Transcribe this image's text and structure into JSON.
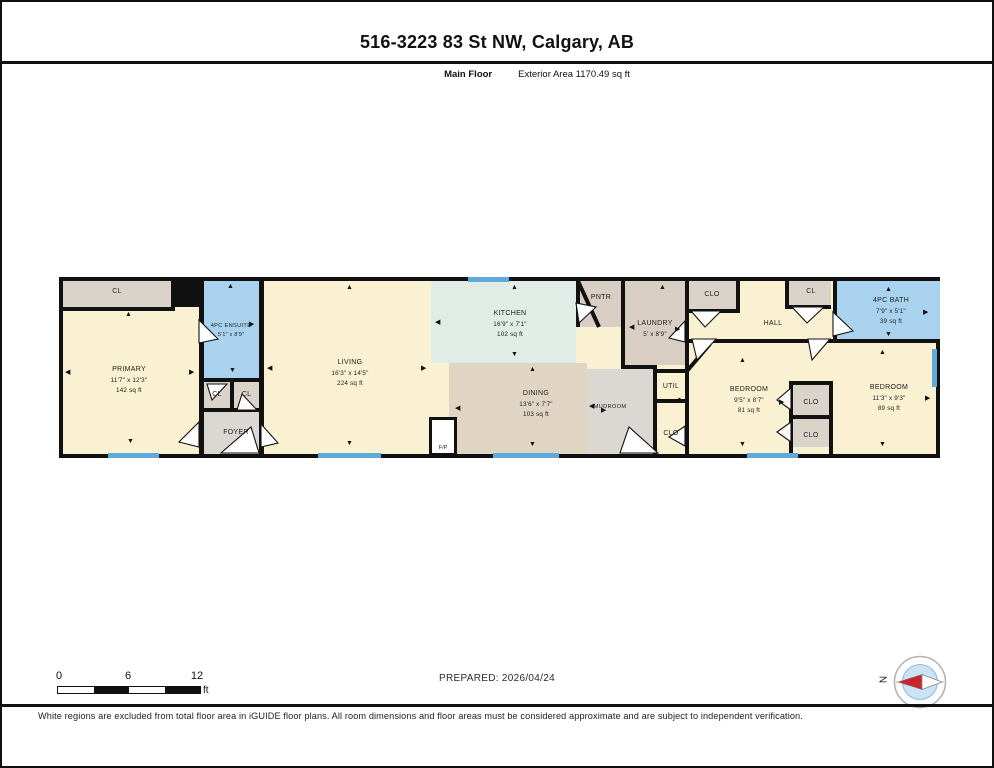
{
  "page": {
    "title": "516-3223 83 St NW, Calgary, AB",
    "floor_label": "Main Floor",
    "area_label": "Exterior Area 1170.49 sq ft",
    "prepared_label": "PREPARED: 2026/04/24",
    "compass_north": "N",
    "disclaimer": "White regions are excluded from total floor area in iGUIDE floor plans. All room dimensions and floor areas must be considered approximate and are subject to independent verification."
  },
  "scale_bar": {
    "start": "0",
    "mid": "6",
    "end": "12",
    "unit": "ft"
  },
  "colors": {
    "room": "#FAF1D2",
    "wet": "#A9D2EF",
    "kitchen": "#DFEDE6",
    "dining": "#E0D5C3",
    "laundry": "#D9CEC3",
    "closet": "#D9D3C9",
    "gray": "#DBD8D3",
    "wall": "#111111",
    "window": "#5FA9DB",
    "needle_red": "#C9252C",
    "compass_blue": "#CBE3F5"
  },
  "floorplan": {
    "rooms": {
      "cl_left": {
        "name": "CL"
      },
      "primary": {
        "name": "PRIMARY",
        "dims": "11'7\" x 12'3\"",
        "area": "142 sq ft"
      },
      "ensuite": {
        "name": "4PC ENSUITE",
        "dims": "5'1\" x 8'9\""
      },
      "cl_a": {
        "name": "CL"
      },
      "cl_b": {
        "name": "CL"
      },
      "foyer": {
        "name": "FOYER"
      },
      "living": {
        "name": "LIVING",
        "dims": "16'3\" x 14'5\"",
        "area": "224 sq ft"
      },
      "kitchen": {
        "name": "KITCHEN",
        "dims": "16'9\" x 7'1\"",
        "area": "102 sq ft"
      },
      "fireplace": {
        "name": "F/P"
      },
      "dining": {
        "name": "DINING",
        "dims": "13'6\" x 7'7\"",
        "area": "103 sq ft"
      },
      "pantry": {
        "name": "PNTR"
      },
      "laundry": {
        "name": "LAUNDRY",
        "dims": "5' x 8'9\""
      },
      "mudroom": {
        "name": "MUDROOM"
      },
      "util": {
        "name": "UTIL"
      },
      "clo_util": {
        "name": "CLO"
      },
      "clo_hall": {
        "name": "CLO"
      },
      "hall": {
        "name": "HALL"
      },
      "cl_hall": {
        "name": "CL"
      },
      "bedroom_mid": {
        "name": "BEDROOM",
        "dims": "9'5\" x 8'7\"",
        "area": "81 sq ft"
      },
      "clo_1": {
        "name": "CLO"
      },
      "clo_2": {
        "name": "CLO"
      },
      "bedroom_right": {
        "name": "BEDROOM",
        "dims": "11'3\" x 9'3\"",
        "area": "89 sq ft"
      },
      "bath": {
        "name": "4PC BATH",
        "dims": "7'9\" x 5'1\"",
        "area": "39 sq ft"
      }
    },
    "windows": [
      {
        "x": 405,
        "y": -4,
        "w": 41,
        "h": 5
      },
      {
        "x": 45,
        "y": 172,
        "w": 51,
        "h": 5
      },
      {
        "x": 255,
        "y": 172,
        "w": 63,
        "h": 5
      },
      {
        "x": 430,
        "y": 172,
        "w": 66,
        "h": 5
      },
      {
        "x": 684,
        "y": 172,
        "w": 51,
        "h": 5
      },
      {
        "x": 869,
        "y": 68,
        "w": 5,
        "h": 38
      }
    ],
    "arrows": [
      {
        "x": 62,
        "y": 30,
        "g": "▲"
      },
      {
        "x": 64,
        "y": 157,
        "g": "▼"
      },
      {
        "x": 2,
        "y": 88,
        "g": "◀"
      },
      {
        "x": 126,
        "y": 88,
        "g": "▶"
      },
      {
        "x": 164,
        "y": 2,
        "g": "▲"
      },
      {
        "x": 186,
        "y": 40,
        "g": "▶"
      },
      {
        "x": 166,
        "y": 86,
        "g": "▼"
      },
      {
        "x": 283,
        "y": 3,
        "g": "▲"
      },
      {
        "x": 283,
        "y": 159,
        "g": "▼"
      },
      {
        "x": 204,
        "y": 84,
        "g": "◀"
      },
      {
        "x": 358,
        "y": 84,
        "g": "▶"
      },
      {
        "x": 448,
        "y": 3,
        "g": "▲"
      },
      {
        "x": 372,
        "y": 38,
        "g": "◀"
      },
      {
        "x": 448,
        "y": 70,
        "g": "▼"
      },
      {
        "x": 466,
        "y": 85,
        "g": "▲"
      },
      {
        "x": 392,
        "y": 124,
        "g": "◀"
      },
      {
        "x": 538,
        "y": 126,
        "g": "▶"
      },
      {
        "x": 466,
        "y": 160,
        "g": "▼"
      },
      {
        "x": 566,
        "y": 43,
        "g": "◀"
      },
      {
        "x": 612,
        "y": 45,
        "g": "▶"
      },
      {
        "x": 596,
        "y": 3,
        "g": "▲"
      },
      {
        "x": 526,
        "y": 122,
        "g": "◀"
      },
      {
        "x": 612,
        "y": 116,
        "g": "◀"
      },
      {
        "x": 676,
        "y": 76,
        "g": "▲"
      },
      {
        "x": 676,
        "y": 160,
        "g": "▼"
      },
      {
        "x": 716,
        "y": 118,
        "g": "▶"
      },
      {
        "x": 816,
        "y": 68,
        "g": "▲"
      },
      {
        "x": 816,
        "y": 160,
        "g": "▼"
      },
      {
        "x": 862,
        "y": 114,
        "g": "▶"
      },
      {
        "x": 822,
        "y": 5,
        "g": "▲"
      },
      {
        "x": 860,
        "y": 28,
        "g": "▶"
      },
      {
        "x": 822,
        "y": 50,
        "g": "▼"
      }
    ]
  }
}
